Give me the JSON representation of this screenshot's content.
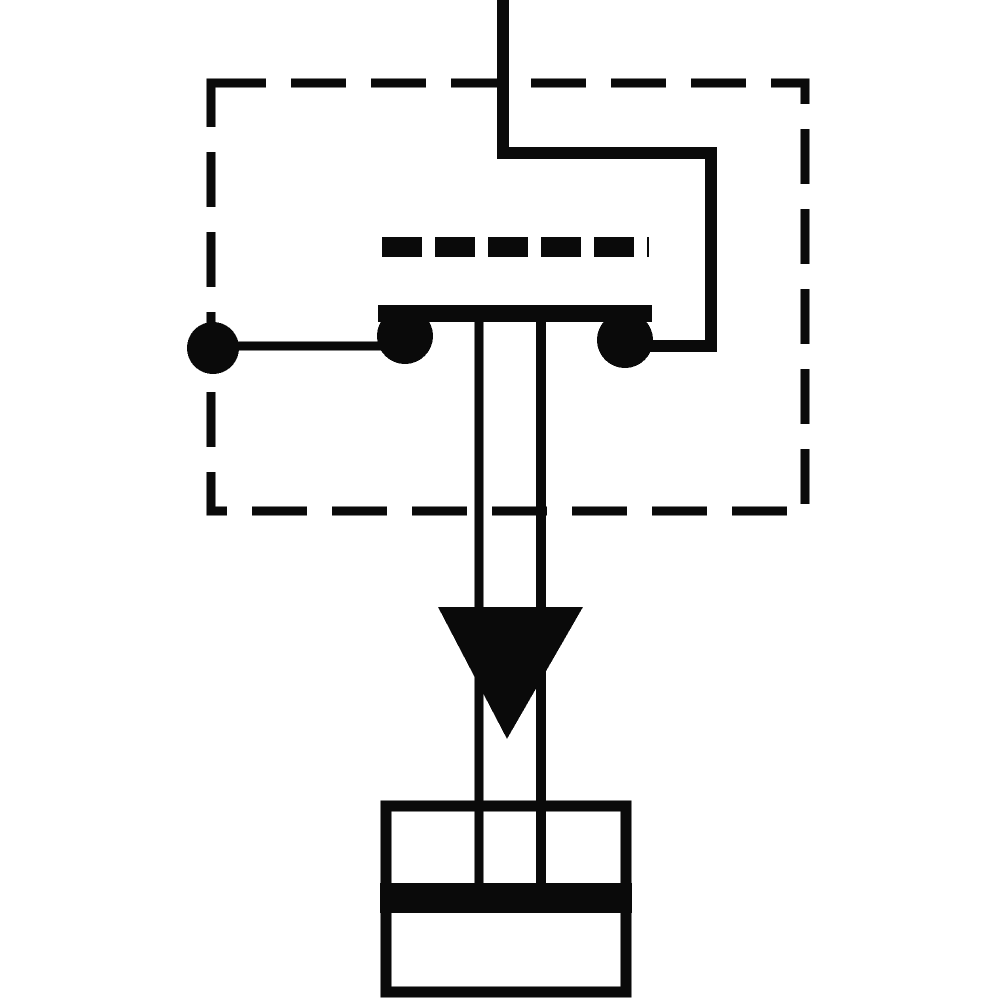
{
  "diagram": {
    "kind": "pressure-switch-circuit-symbol",
    "style": "scanned-monochrome-schematic",
    "colors": {
      "ink": "#0a0a0a",
      "background": "#ffffff"
    },
    "switch_element_dash_count": 6,
    "parts": [
      "component-boundary-dashed-box",
      "supply-line",
      "terminal-connection-line",
      "terminal-junction-dot",
      "switch-element-dash-strip",
      "contact-bridge-bar",
      "contact-left",
      "contact-right",
      "actuator-rod-left-line",
      "actuator-rod-right-line",
      "pressure-direction-arrow",
      "pressure-port-body",
      "pressure-port-seal-band"
    ]
  }
}
